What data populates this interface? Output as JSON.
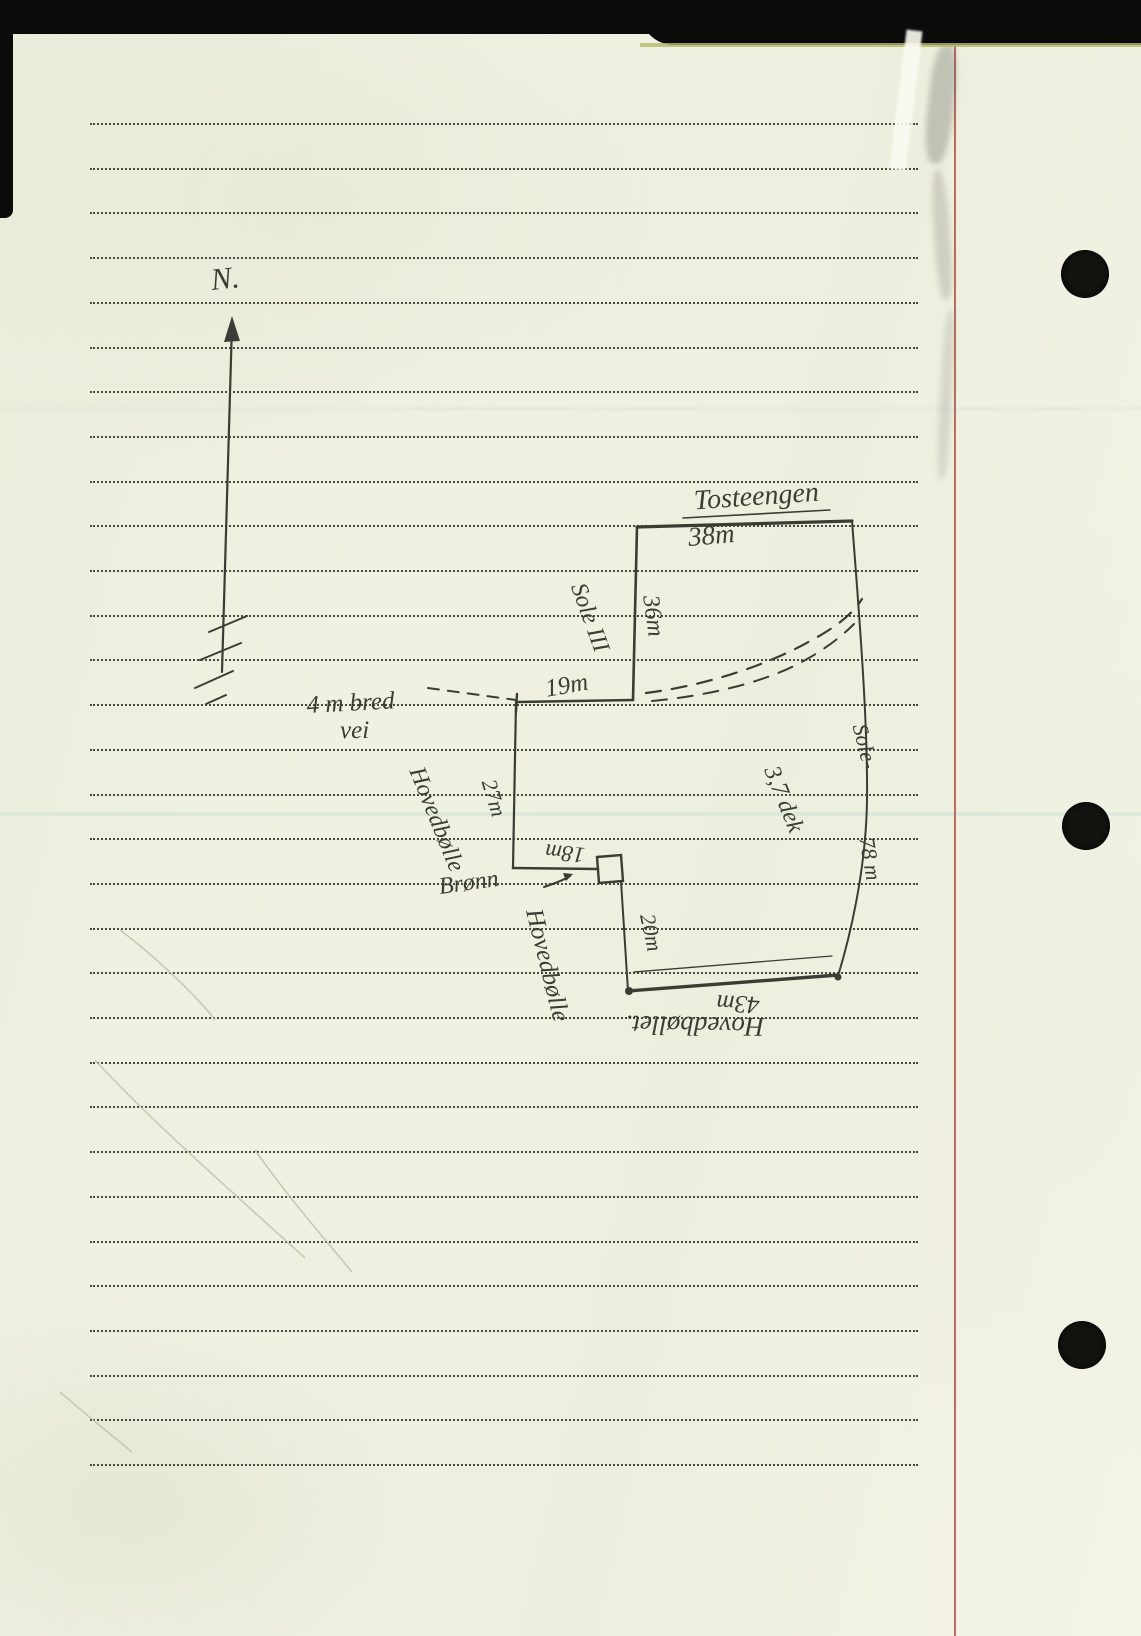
{
  "colors": {
    "paper": "#eef0df",
    "rule_dots": "#48483e",
    "margin_line": "#b8504a",
    "ink": "#3a3d34"
  },
  "sketch": {
    "north": "N.",
    "top_name": "Tosteengen",
    "top_len": "38m",
    "nw_len": "36m",
    "parcel_upper": "Sole III",
    "mid_len": "19m",
    "road1": "4 m bred",
    "road2": "vei",
    "w_len": "27m",
    "w_neighbor": "Hovedbølle",
    "well_len": "18m",
    "well": "Brønn",
    "sw_len": "20m",
    "s_neighbor_inner": "Hovedbølle",
    "area": "3,7 dek",
    "e_neighbor": "Sole-",
    "e_len": "78 m",
    "s_len": "43m",
    "s_neighbor": "Hovedbøllet."
  }
}
